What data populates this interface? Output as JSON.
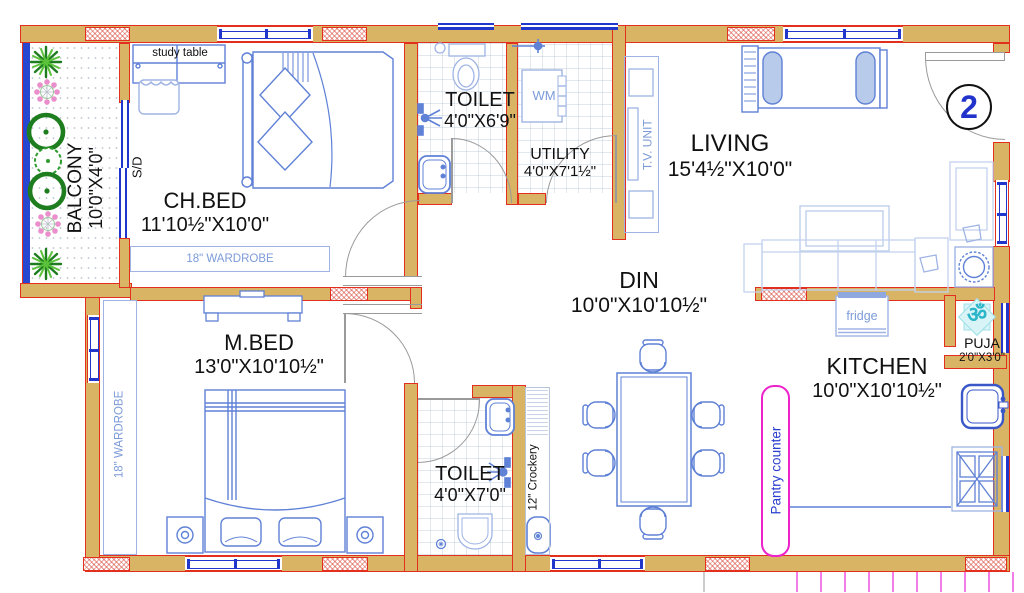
{
  "plan_title": "2BHK floor plan drawing",
  "entrance": {
    "door_number": "2"
  },
  "rooms": {
    "balcony": {
      "name": "BALCONY",
      "size": "10'0\"X4'0\""
    },
    "chbed": {
      "name": "CH.BED",
      "size": "11'10½\"X10'0\""
    },
    "toilet1": {
      "name": "TOILET",
      "size": "4'0\"X6'9\""
    },
    "utility": {
      "name": "UTILITY",
      "size": "4'0\"X7'1½\""
    },
    "living": {
      "name": "LIVING",
      "size": "15'4½\"X10'0\""
    },
    "mbed": {
      "name": "M.BED",
      "size": "13'0\"X10'10½\""
    },
    "toilet2": {
      "name": "TOILET",
      "size": "4'0\"X7'0\""
    },
    "din": {
      "name": "DIN",
      "size": "10'0\"X10'10½\""
    },
    "kitchen": {
      "name": "KITCHEN",
      "size": "10'0\"X10'10½\""
    },
    "puja": {
      "name": "PUJA",
      "size": "2'0\"X3'0\""
    }
  },
  "fixtures": {
    "study_table": "study table",
    "chbed_wardrobe": "18\" WARDROBE",
    "mbed_wardrobe": "18\" WARDROBE",
    "sliding_door": "S/D",
    "washing_machine": "WM",
    "tv_unit": "T.V. UNIT",
    "crockery_shelf": "12\" Crockery",
    "fridge": "fridge",
    "pantry_counter": "Pantry counter",
    "om_symbol": "ॐ"
  },
  "colors": {
    "wall_fill": "#D9B465",
    "wall_outline": "#E3301E",
    "window_blue": "#2136CB",
    "furniture_blue": "#5F81D6",
    "furniture_light_blue": "#9FB4E4",
    "label_light_blue": "#7C9BD8",
    "pantry_magenta": "#EE22CC",
    "plant_green": "#1E7D1E",
    "om_cyan": "#2BB5C8",
    "entrance_number_blue": "#2233CC"
  }
}
